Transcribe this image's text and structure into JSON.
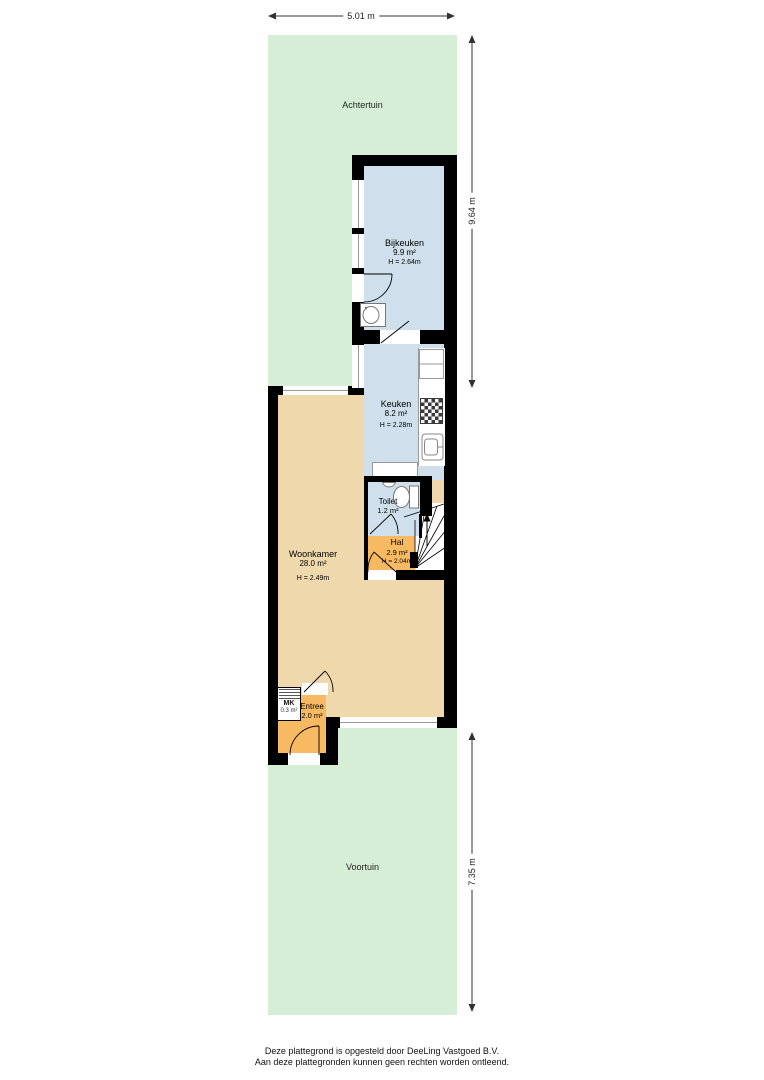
{
  "dimensions": {
    "width_top": "5.01 m",
    "height_back_garden": "9.64 m",
    "height_front_garden": "7.35 m"
  },
  "gardens": {
    "back_label": "Achtertuin",
    "front_label": "Voortuin"
  },
  "rooms": {
    "bijkeuken": {
      "name": "Bijkeuken",
      "area": "9.9 m²",
      "ceiling": "H = 2.64m"
    },
    "keuken": {
      "name": "Keuken",
      "area": "8.2 m²",
      "ceiling": "H = 2.28m"
    },
    "toilet": {
      "name": "Toilet",
      "area": "1.2 m²"
    },
    "hal": {
      "name": "Hal",
      "area": "2.9 m²",
      "ceiling": "H = 2.04m"
    },
    "woonkamer": {
      "name": "Woonkamer",
      "area": "28.0 m²",
      "ceiling": "H = 2.49m"
    },
    "entree": {
      "name": "Entree",
      "area": "2.0 m²"
    },
    "meterkast": {
      "name": "MK",
      "area": "0.3 m²"
    }
  },
  "footer": {
    "line1": "Deze plattegrond is opgesteld door DeeLing Vastgoed B.V.",
    "line2": "Aan deze plattegronden kunnen geen rechten worden ontleend."
  },
  "colors": {
    "garden_green": "#d6eed6",
    "room_blue": "#cfe0ec",
    "room_tan": "#f0d8ad",
    "room_orange": "#f7ba62",
    "wall_black": "#000000"
  }
}
